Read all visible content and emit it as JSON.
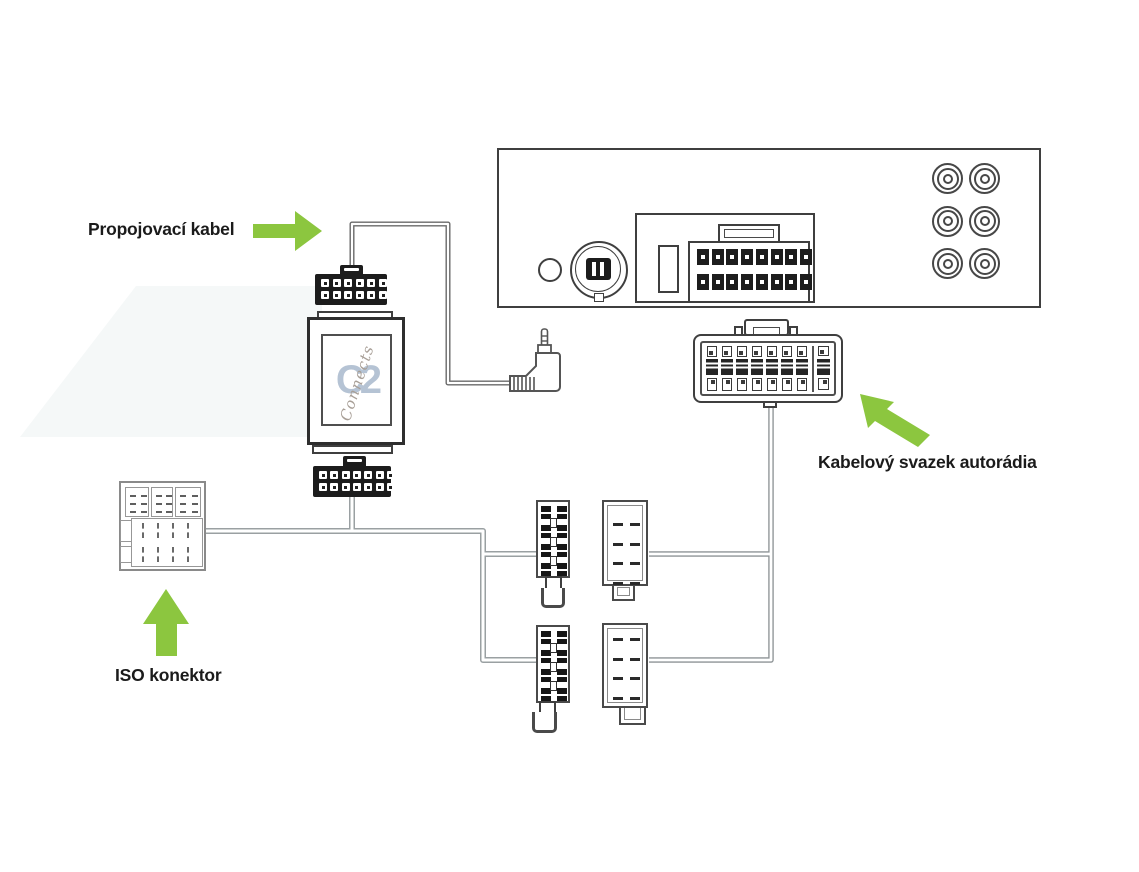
{
  "diagram": {
    "labels": {
      "connection_cable": "Propojovací kabel",
      "harness": "Kabelový svazek autorádia",
      "iso": "ISO konektor"
    },
    "adapter_logo": {
      "monogram": "C2",
      "script": "Connects"
    },
    "colors": {
      "arrow_green": "#8cc63f",
      "outline_dark": "#3f3f3f",
      "wire_grey": "#9aa0a2",
      "cable_grey": "#6a6a6a",
      "logo_blue": "#b5c3d4",
      "logo_script": "#a89f97",
      "watermark": "#f5f8f8"
    }
  }
}
